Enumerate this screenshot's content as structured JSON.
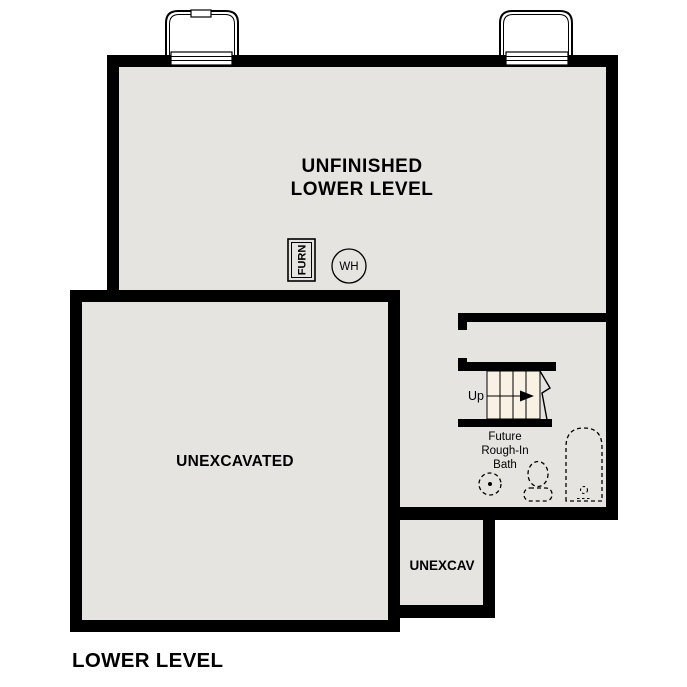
{
  "page_title": "LOWER LEVEL",
  "colors": {
    "wall": "#000000",
    "floor": "#e6e4e1",
    "stair_tread": "#f9f2e4",
    "background": "#ffffff",
    "line": "#000000"
  },
  "rooms": {
    "unfinished_lower_level": {
      "label_line1": "UNFINISHED",
      "label_line2": "LOWER LEVEL"
    },
    "unexcavated": {
      "label": "UNEXCAVATED"
    },
    "unexcav": {
      "label": "UNEXCAV"
    },
    "future_bath": {
      "label_line1": "Future",
      "label_line2": "Rough-In",
      "label_line3": "Bath"
    }
  },
  "stairs": {
    "direction_label": "Up"
  },
  "equipment": {
    "furnace_label": "FURN",
    "water_heater_label": "WH"
  }
}
